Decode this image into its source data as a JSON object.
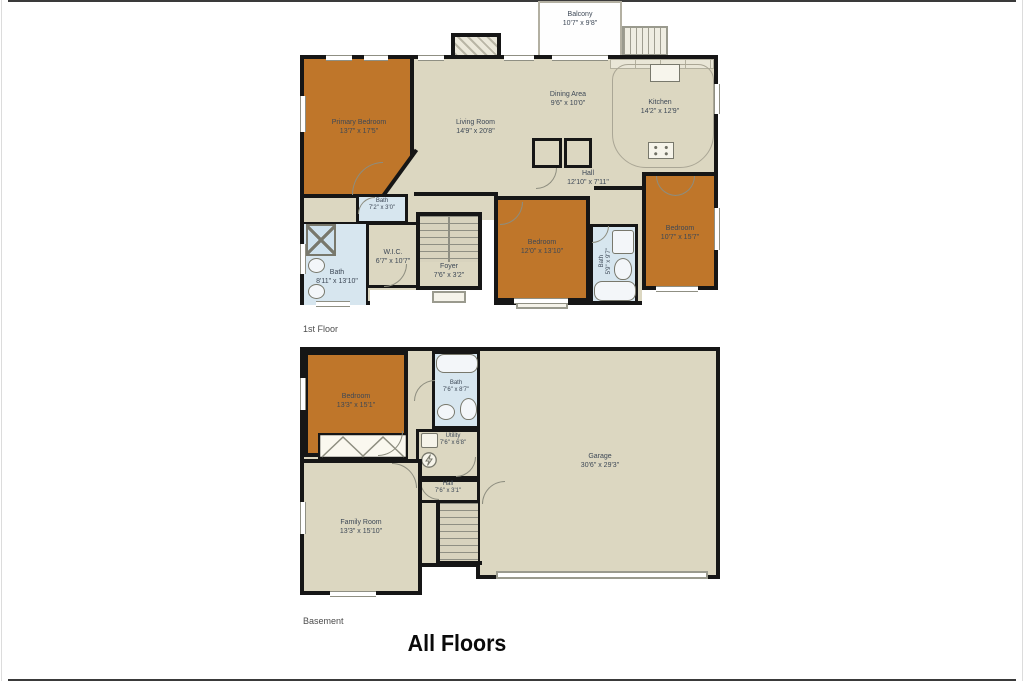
{
  "page": {
    "title": "All Floors"
  },
  "colors": {
    "wall": "#161616",
    "floor_fill": "#dcd7c1",
    "bedroom_fill": "#bf762a",
    "bath_fill": "#d7e6ef",
    "label_text": "#3d4856",
    "title_text": "#0a0a0a"
  },
  "floors": [
    {
      "name": "1st Floor",
      "rooms": [
        {
          "label": "Balcony",
          "dims": "10'7\" x 9'8\""
        },
        {
          "label": "Primary Bedroom",
          "dims": "13'7\" x 17'5\""
        },
        {
          "label": "Living Room",
          "dims": "14'9\" x 20'8\""
        },
        {
          "label": "Dining Area",
          "dims": "9'6\" x 10'0\""
        },
        {
          "label": "Kitchen",
          "dims": "14'2\" x 12'9\""
        },
        {
          "label": "Hall",
          "dims": "12'10\" x 7'11\""
        },
        {
          "label": "Bath",
          "dims": "7'2\" x 3'0\""
        },
        {
          "label": "W.I.C.",
          "dims": "6'7\" x 10'7\""
        },
        {
          "label": "Bath",
          "dims": "8'11\" x 13'10\""
        },
        {
          "label": "Foyer",
          "dims": "7'6\" x 3'2\""
        },
        {
          "label": "Bedroom",
          "dims": "12'0\" x 13'10\""
        },
        {
          "label": "Bath",
          "dims": "5'9\" x 9'7\""
        },
        {
          "label": "Bedroom",
          "dims": "10'7\" x 15'7\""
        }
      ]
    },
    {
      "name": "Basement",
      "rooms": [
        {
          "label": "Bedroom",
          "dims": "13'3\" x 15'1\""
        },
        {
          "label": "Bath",
          "dims": "7'6\" x 8'7\""
        },
        {
          "label": "Utility",
          "dims": "7'6\" x 6'8\""
        },
        {
          "label": "Hall",
          "dims": "7'6\" x 3'1\""
        },
        {
          "label": "Family Room",
          "dims": "13'3\" x 15'10\""
        },
        {
          "label": "Garage",
          "dims": "30'6\" x 29'3\""
        }
      ]
    }
  ]
}
